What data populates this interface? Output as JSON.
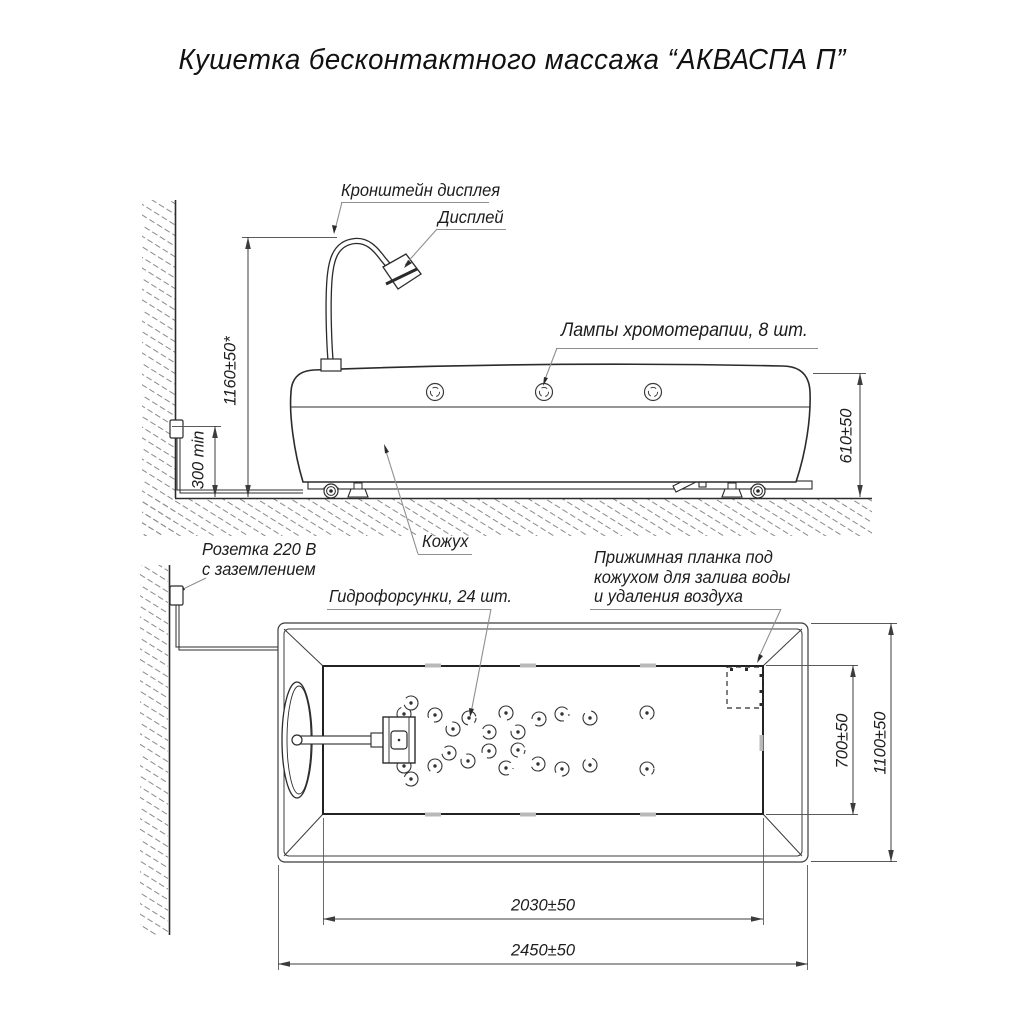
{
  "title": "Кушетка бесконтактного массажа “АКВАСПА П”",
  "side_view": {
    "labels": {
      "bracket": "Кронштейн дисплея",
      "display": "Дисплей",
      "lamps": "Лампы хромотерапии, 8 шт.",
      "socket_line1": "Розетка 220 В",
      "socket_line2": "с заземлением",
      "cover": "Кожух"
    },
    "dims": {
      "bracket_height": "1160±50*",
      "socket_height_min": "300 min",
      "couch_height": "610±50"
    }
  },
  "plan_view": {
    "labels": {
      "nozzles": "Гидрофорсунки, 24 шт.",
      "clamp_line1": "Прижимная планка под",
      "clamp_line2": "кожухом для залива воды",
      "clamp_line3": "и удаления воздуха"
    },
    "dims": {
      "basin_width": "700±50",
      "overall_width": "1100±50",
      "basin_length": "2030±50",
      "overall_length": "2450±50"
    }
  },
  "counts": {
    "chromotherapy_lamps": 8,
    "hydro_nozzles": 24
  },
  "colors": {
    "line": "#2b2b2b",
    "dim_line": "#3c3c3c",
    "extension_line": "#5a5a5a",
    "leader_line": "#8f8f8f",
    "hatch": "#8a8a8a",
    "background": "#ffffff"
  }
}
